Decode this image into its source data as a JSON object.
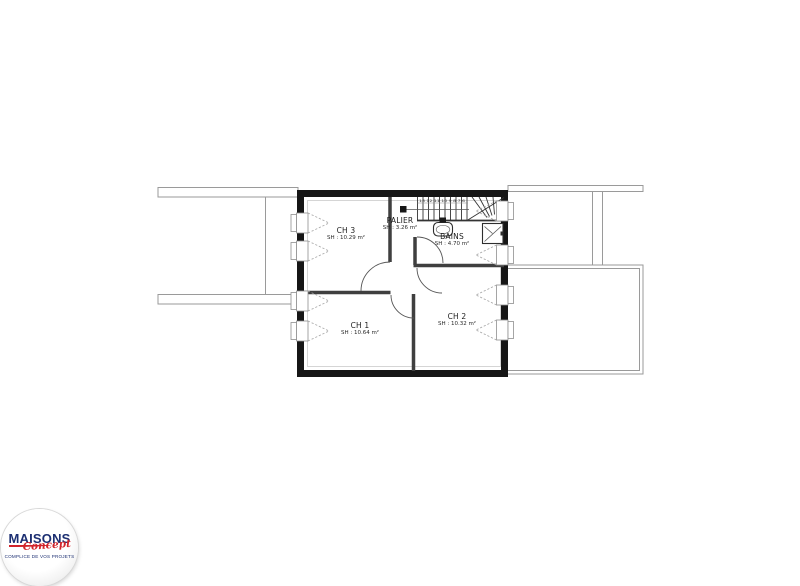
{
  "colors": {
    "wall": "#161616",
    "partition": "#3f3f3f",
    "thin": "#9a9a9a",
    "dash": "#a5a5a5",
    "stair": "#333333",
    "ink": "#1c1c1c",
    "logo_navy": "#1c2f72",
    "logo_red": "#d2232a"
  },
  "rooms": [
    {
      "id": "ch3",
      "name": "CH 3",
      "area": "SH : 10.29 m²"
    },
    {
      "id": "palier",
      "name": "PALIER",
      "area": "SH : 3.26 m²"
    },
    {
      "id": "bains",
      "name": "BAINS",
      "area": "SH : 4.70 m²"
    },
    {
      "id": "ch1",
      "name": "CH 1",
      "area": "SH : 10.64 m²"
    },
    {
      "id": "ch2",
      "name": "CH 2",
      "area": "SH : 10.32 m²"
    }
  ],
  "stairs": {
    "step_numbers": "13 12 11 10 9 8 7 6"
  },
  "logo": {
    "brand": "MAISONS",
    "script": "Concept",
    "tagline": "COMPLICE DE VOS PROJETS"
  }
}
